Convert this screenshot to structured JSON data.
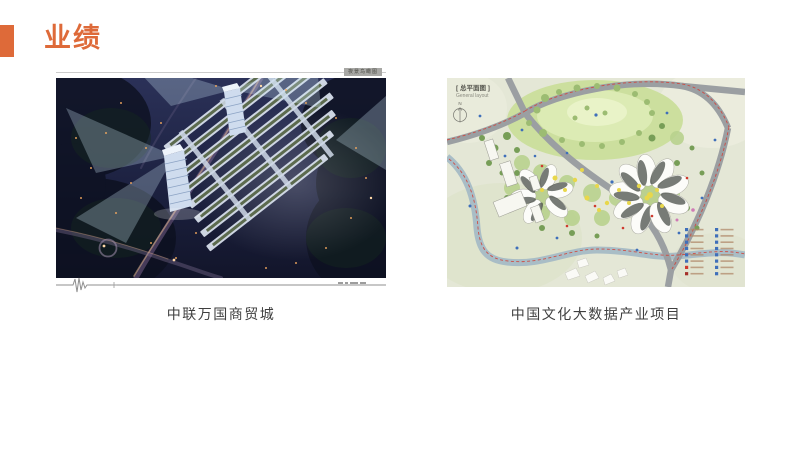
{
  "slide": {
    "title": "业绩"
  },
  "colors": {
    "accent": "#DE6A39",
    "caption_text": "#3F3F3F",
    "legend_blue": "#3F6FBA",
    "legend_red": "#CF3A2E"
  },
  "figures": {
    "left": {
      "caption": "中联万国商贸城",
      "tag": "夜景鸟瞰图"
    },
    "right": {
      "caption": "中国文化大数据产业项目",
      "label_cn": "[ 总平面图 ]",
      "label_en": "General layout",
      "north_letter": "N"
    }
  }
}
